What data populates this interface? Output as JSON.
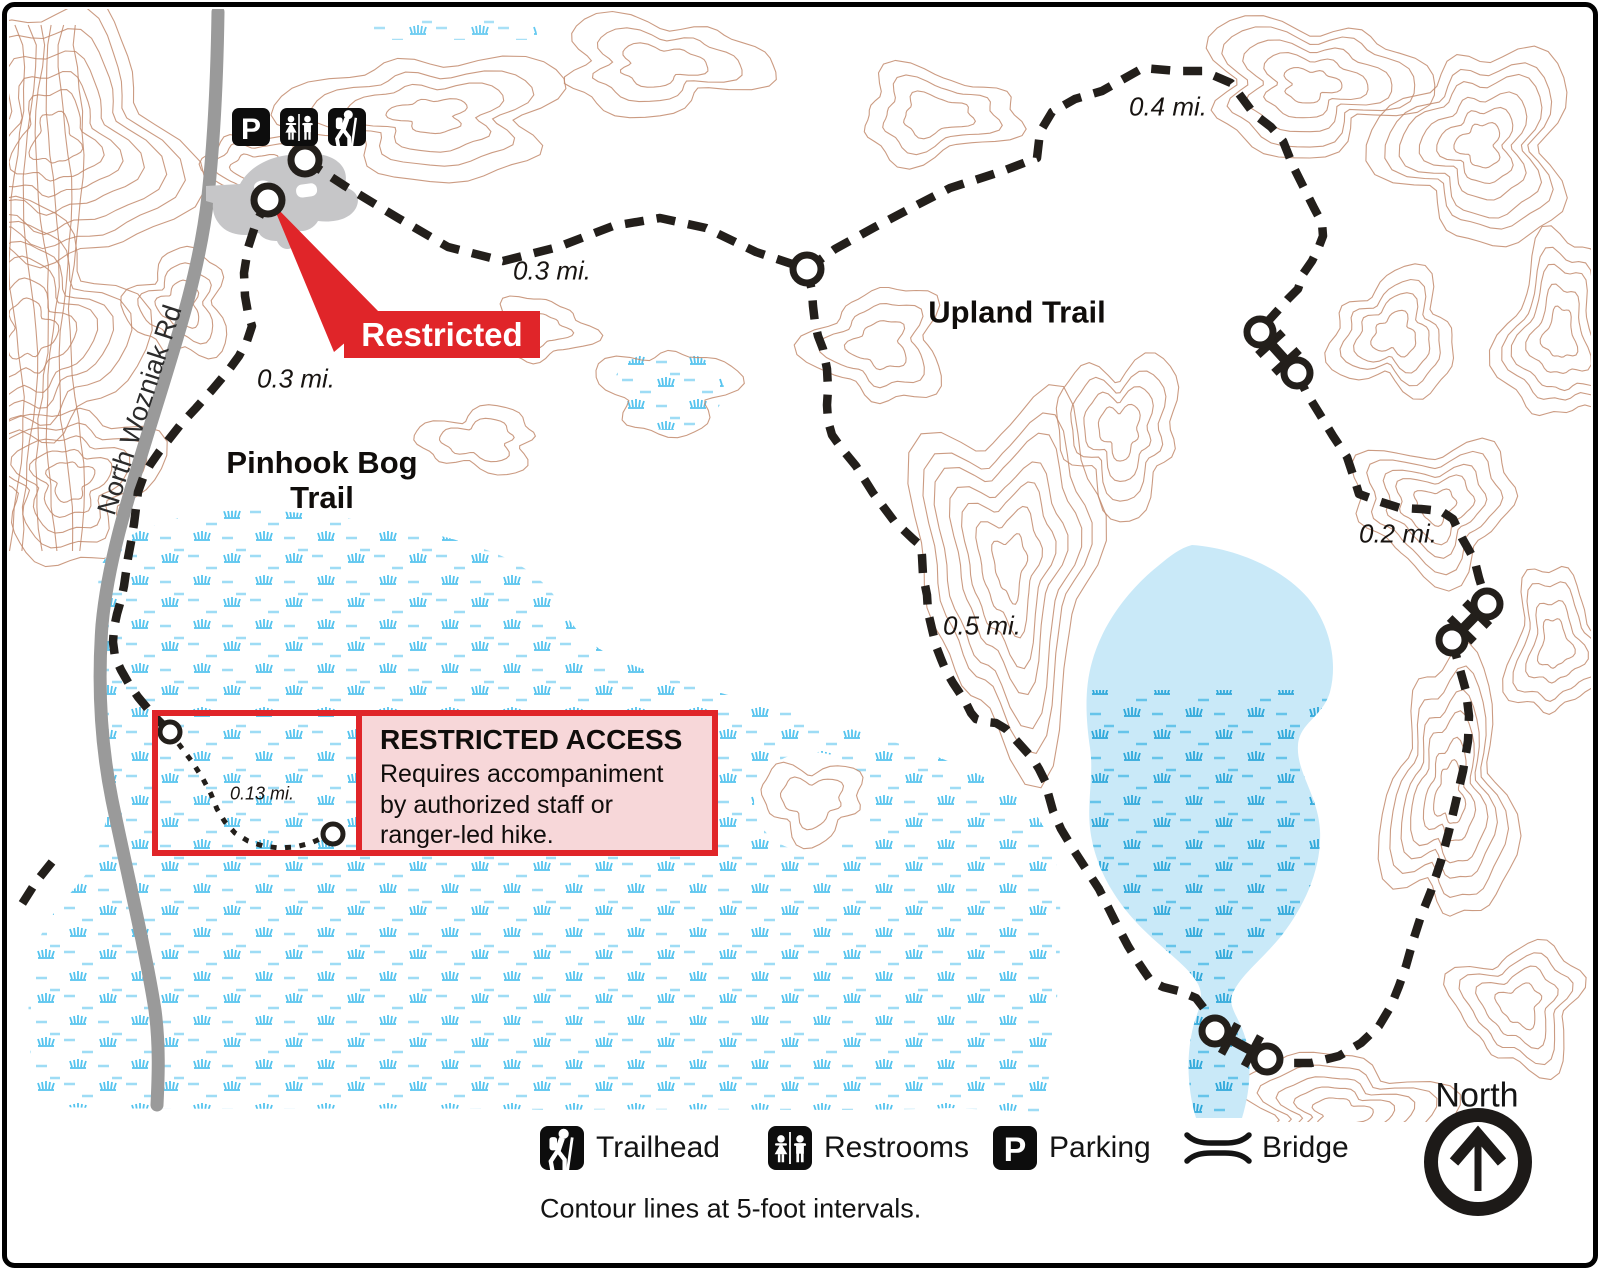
{
  "labels": {
    "road": "North Wozniak Rd",
    "pinhook_line1": "Pinhook Bog",
    "pinhook_line2": "Trail",
    "upland": "Upland Trail"
  },
  "distances": {
    "north_segment": "0.3 mi.",
    "west_segment": "0.3 mi.",
    "upland_segment": "0.4 mi.",
    "east_segment": "0.2 mi.",
    "middle_segment": "0.5 mi.",
    "restricted_segment": "0.13 mi."
  },
  "callout": {
    "label": "Restricted"
  },
  "restricted_box": {
    "title": "RESTRICTED ACCESS",
    "body": "Requires accompaniment by authorized staff or ranger-led hike."
  },
  "legend": {
    "items": [
      {
        "icon": "trailhead-icon",
        "label": "Trailhead"
      },
      {
        "icon": "restrooms-icon",
        "label": "Restrooms"
      },
      {
        "icon": "parking-icon",
        "label": "Parking"
      },
      {
        "icon": "bridge-icon",
        "label": "Bridge"
      }
    ],
    "note": "Contour lines at 5-foot intervals."
  },
  "compass": {
    "label": "North"
  },
  "icons": {
    "parking_letter": "P"
  },
  "colors": {
    "accent_red": "#e02529",
    "panel_pink": "#f7d7d9",
    "lake_blue": "#c9e9f8",
    "marsh_blue": "#54c3ee",
    "contour_tan": "#c28a6c",
    "road_gray": "#9a9a9a",
    "trail_black": "#231f1b"
  }
}
